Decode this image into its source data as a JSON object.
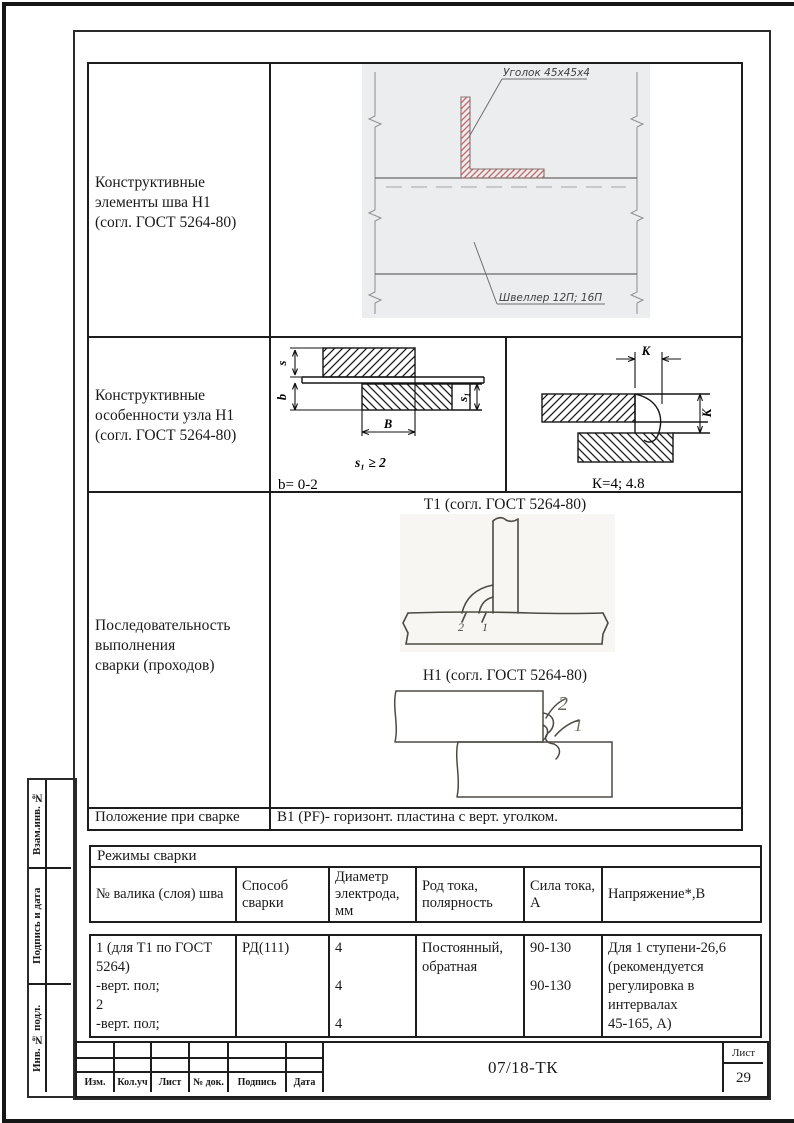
{
  "spec": {
    "row1_label": [
      "Конструктивные",
      "элементы шва Н1",
      "(согл. ГОСТ 5264-80)"
    ],
    "row1_angle_label": "Уголок 45х45х4",
    "row1_channel_label": "Швеллер 12П; 16П",
    "row2_label": [
      "Конструктивные",
      "особенности узла Н1",
      "(согл. ГОСТ 5264-80)"
    ],
    "dim_s": "s",
    "dim_b": "b",
    "dim_B": "В",
    "dim_s1": "s₁",
    "dim_K_top": "К",
    "dim_K_right": "К",
    "row2_formula": "s₁ ≥ 2",
    "row2_note_b": "b= 0-2",
    "row2_note_K": "К=4; 4.8",
    "row3_label": [
      "Последовательность",
      "выполнения",
      "сварки (проходов)"
    ],
    "row3_t1_title": "Т1 (согл. ГОСТ 5264-80)",
    "row3_h1_title": "Н1 (согл. ГОСТ 5264-80)",
    "t1_pass_2": "2",
    "t1_pass_1": "1",
    "h1_pass_2": "2",
    "h1_pass_1": "1",
    "row4_label": "Положение при сварке",
    "row4_value": "В1 (PF)- горизонт. пластина с верт. уголком."
  },
  "modes": {
    "title": "Режимы сварки",
    "headers": [
      "№ валика (слоя) шва",
      "Способ сварки",
      "Диаметр электрода, мм",
      "Род тока, полярность",
      "Сила тока, А",
      "Напряжение*,В"
    ],
    "seam_lines": [
      "1 (для Т1 по ГОСТ 5264)",
      "-верт. пол;",
      "2",
      "-верт. пол;"
    ],
    "method": "РД(111)",
    "diameters": [
      "4",
      "4",
      "4"
    ],
    "current_kind": "Постоянный, обратная",
    "current_values": [
      "90-130",
      "90-130"
    ],
    "voltage_lines": [
      "Для 1 ступени-26,6",
      "(рекомендуется",
      "регулировка в",
      "интервалах",
      "45-165, А)"
    ]
  },
  "title_block": {
    "doc_number": "07/18-ТК",
    "sheet_label": "Лист",
    "sheet_number": "29",
    "bottom_labels": [
      "Изм.",
      "Кол.уч",
      "Лист",
      "№ док.",
      "Подпись",
      "Дата"
    ]
  },
  "side_stamp": {
    "labels": [
      "Взам.инв. №",
      "Подпись и дата",
      "Инв. № подл."
    ]
  }
}
